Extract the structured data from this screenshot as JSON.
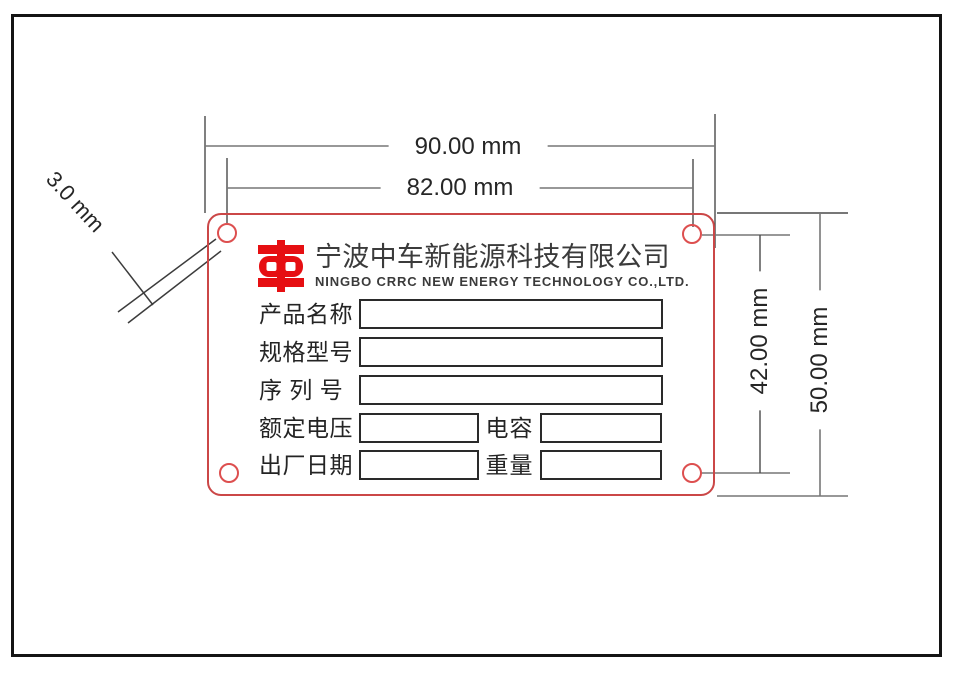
{
  "drawing": {
    "dim_width_outer": "90.00 mm",
    "dim_width_holes": "82.00 mm",
    "dim_height_holes": "42.00 mm",
    "dim_height_outer": "50.00 mm",
    "dim_hole_diameter": "3.0 mm"
  },
  "plate": {
    "company_name_cn": "宁波中车新能源科技有限公司",
    "company_name_en": "NINGBO CRRC NEW ENERGY TECHNOLOGY CO.,LTD.",
    "fields": {
      "product_name_label": "产品名称",
      "spec_model_label": "规格型号",
      "serial_number_label": "序 列 号",
      "rated_voltage_label": "额定电压",
      "capacitance_label": "电容",
      "manufacture_date_label": "出厂日期",
      "weight_label": "重量"
    },
    "colors": {
      "plate_border_red": "#cb4747",
      "logo_red": "#e60f12",
      "hole_red": "#dd4f4f"
    }
  }
}
